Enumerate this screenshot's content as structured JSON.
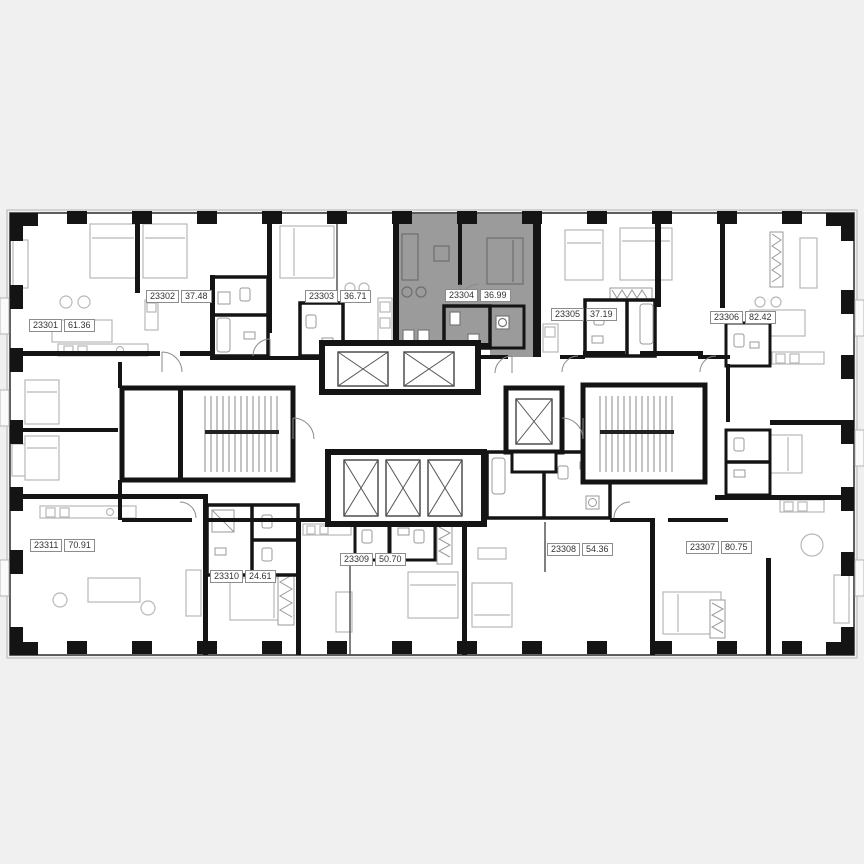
{
  "canvas": {
    "width": 864,
    "height": 864,
    "background": "#f0f0f0"
  },
  "colors": {
    "plan_fill": "#ffffff",
    "wall": "#141414",
    "furniture_line": "#b8b8b8",
    "door_arc": "#8a8a8a",
    "highlight_fill": "#9b9b9b",
    "label_border": "#8c8c8c",
    "label_text": "#333333"
  },
  "floor_plan": {
    "selected_unit": "23304",
    "units": [
      {
        "id": "23301",
        "area": "61.36",
        "highlighted": false
      },
      {
        "id": "23302",
        "area": "37.48",
        "highlighted": false
      },
      {
        "id": "23303",
        "area": "36.71",
        "highlighted": false
      },
      {
        "id": "23304",
        "area": "36.99",
        "highlighted": true
      },
      {
        "id": "23305",
        "area": "37.19",
        "highlighted": false
      },
      {
        "id": "23306",
        "area": "82.42",
        "highlighted": false
      },
      {
        "id": "23307",
        "area": "80.75",
        "highlighted": false
      },
      {
        "id": "23308",
        "area": "54.36",
        "highlighted": false
      },
      {
        "id": "23309",
        "area": "50.70",
        "highlighted": false
      },
      {
        "id": "23310",
        "area": "24.61",
        "highlighted": false
      },
      {
        "id": "23311",
        "area": "70.91",
        "highlighted": false
      }
    ],
    "core": {
      "elevators_top_bank": 2,
      "elevators_bottom_bank": 3,
      "elevators_side": 1,
      "stairwells": 2
    }
  }
}
